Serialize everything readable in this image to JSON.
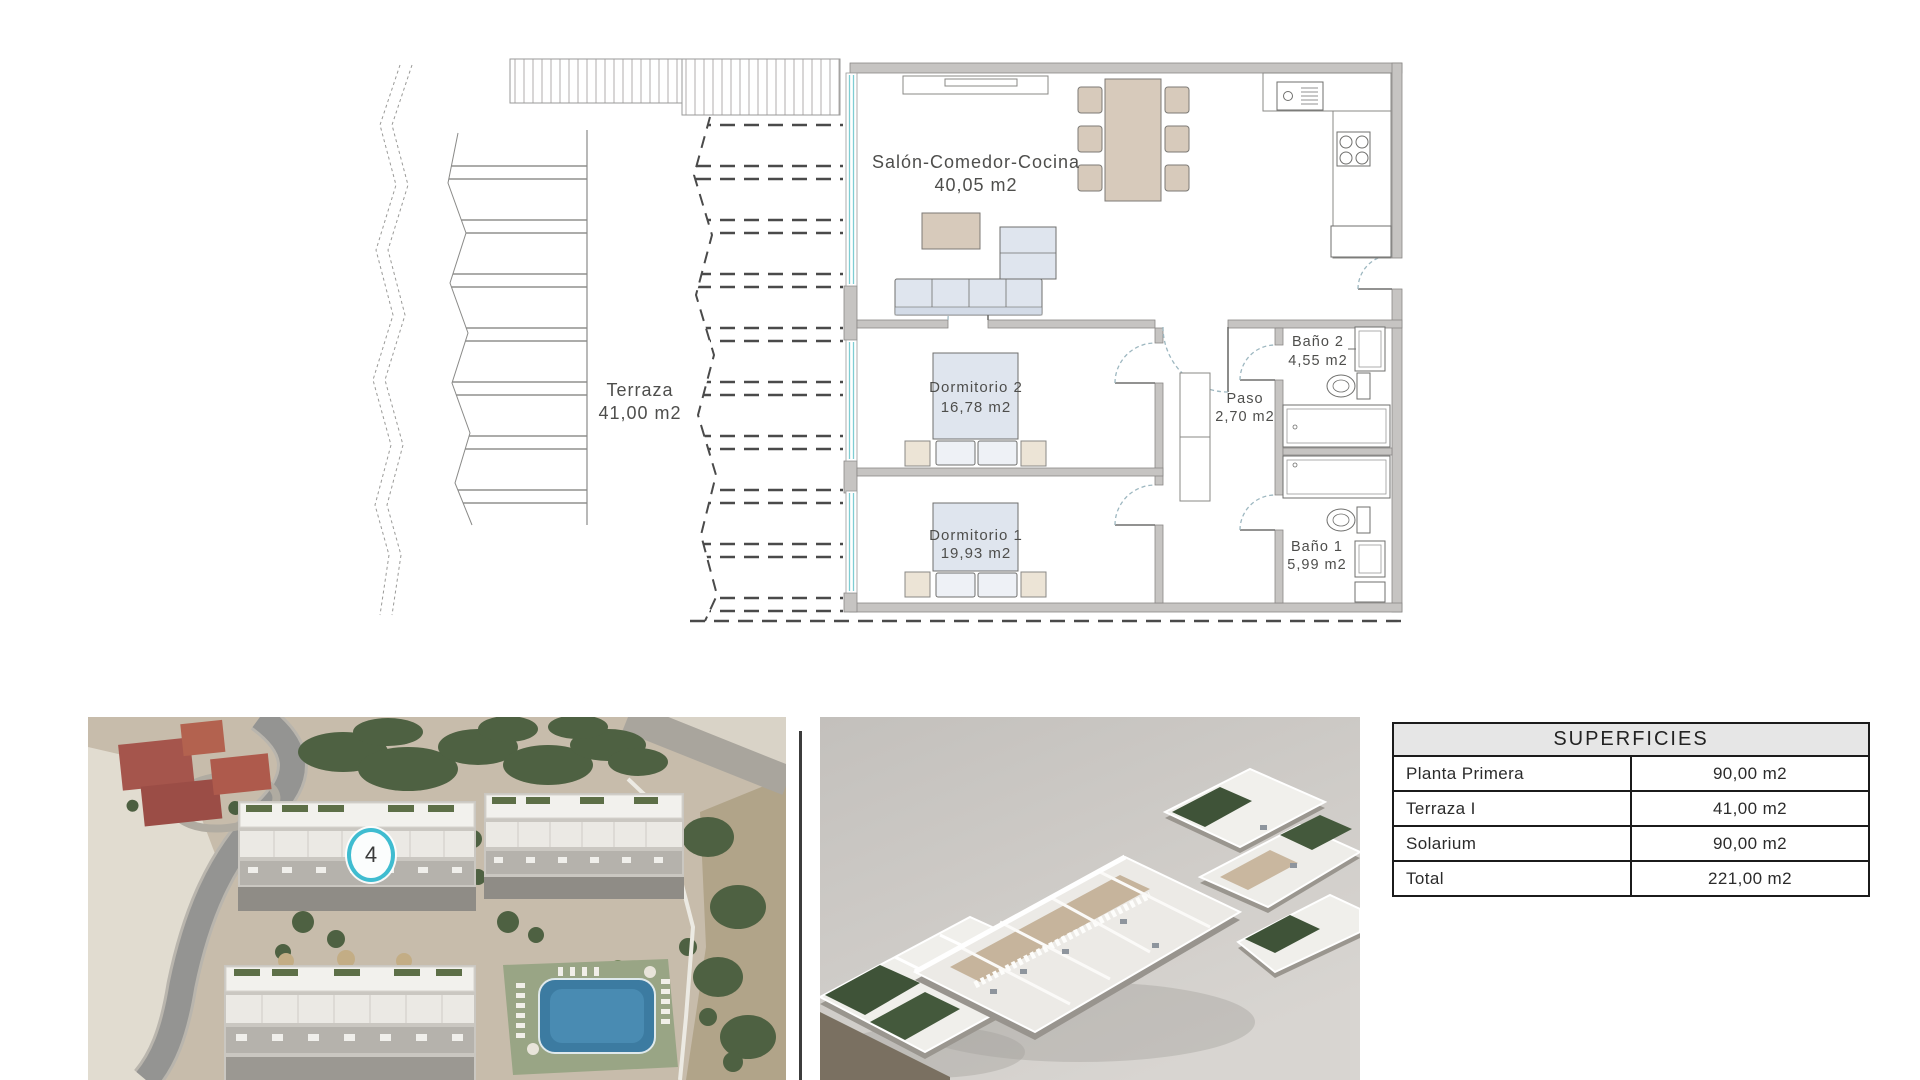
{
  "floor_plan": {
    "rooms": {
      "terraza": {
        "name": "Terraza",
        "area": "41,00 m2"
      },
      "salon": {
        "name": "Salón-Comedor-Cocina",
        "area": "40,05 m2"
      },
      "dormitorio2": {
        "name": "Dormitorio 2",
        "area": "16,78 m2"
      },
      "dormitorio1": {
        "name": "Dormitorio 1",
        "area": "19,93 m2"
      },
      "bano2": {
        "name": "Baño 2",
        "area": "4,55 m2"
      },
      "paso": {
        "name": "Paso",
        "area": "2,70 m2"
      },
      "bano1": {
        "name": "Baño 1",
        "area": "5,99 m2"
      }
    }
  },
  "aerial_photo": {
    "unit_marker": "4"
  },
  "surfaces_table": {
    "title": "SUPERFICIES",
    "rows": [
      {
        "label": "Planta Primera",
        "value": "90,00 m2"
      },
      {
        "label": "Terraza I",
        "value": "41,00 m2"
      },
      {
        "label": "Solarium",
        "value": "90,00 m2"
      },
      {
        "label": "Total",
        "value": "221,00 m2"
      }
    ]
  },
  "colors": {
    "marker_accent": "#3fbcd0",
    "window_accent": "#7ecdd3",
    "wall_gray": "#c6c4c2",
    "table_header_bg": "#e6e6e6"
  }
}
